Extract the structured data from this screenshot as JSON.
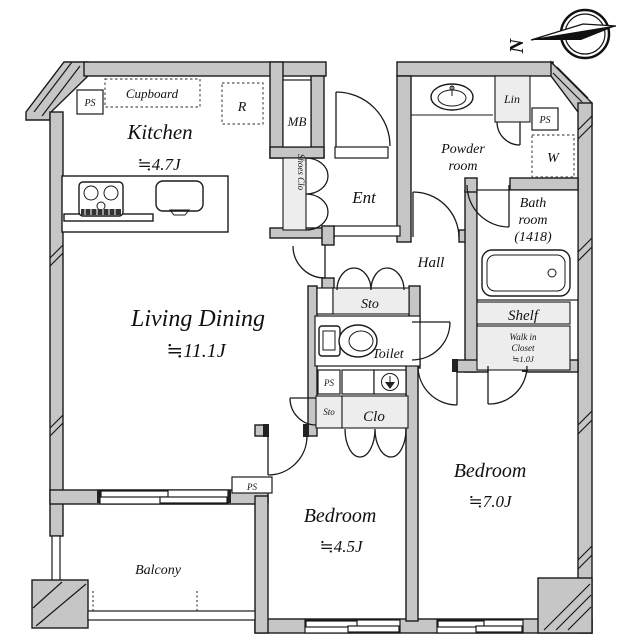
{
  "plan_type": "apartment-floor-plan",
  "colors": {
    "wall_fill": "#c6c6c6",
    "closet_fill": "#ededed",
    "line": "#1a1a1a"
  },
  "compass": {
    "north_label": "N"
  },
  "labels": {
    "kitchen_name": "Kitchen",
    "kitchen_size": "≒4.7J",
    "living_name": "Living Dining",
    "living_size": "≒11.1J",
    "bedroom_a_name": "Bedroom",
    "bedroom_a_size": "≒4.5J",
    "bedroom_b_name": "Bedroom",
    "bedroom_b_size": "≒7.0J",
    "balcony": "Balcony",
    "ent": "Ent",
    "hall": "Hall",
    "toilet": "Toilet",
    "powder_line1": "Powder",
    "powder_line2": "room",
    "bath_line1": "Bath",
    "bath_line2": "room",
    "bath_line3": "(1418)",
    "wic_line1": "Walk in",
    "wic_line2": "Closet",
    "wic_line3": "≒1.0J",
    "shelf": "Shelf",
    "cupboard": "Cupboard",
    "shoes_clo": "Shoes Clo",
    "lin": "Lin",
    "clo": "Clo",
    "sto_hall": "Sto",
    "sto_small": "Sto",
    "mb": "MB",
    "refrigerator": "R",
    "washer": "W",
    "ps_kitchen": "PS",
    "ps_powder": "PS",
    "ps_toilet": "PS",
    "ps_balcony": "PS"
  }
}
